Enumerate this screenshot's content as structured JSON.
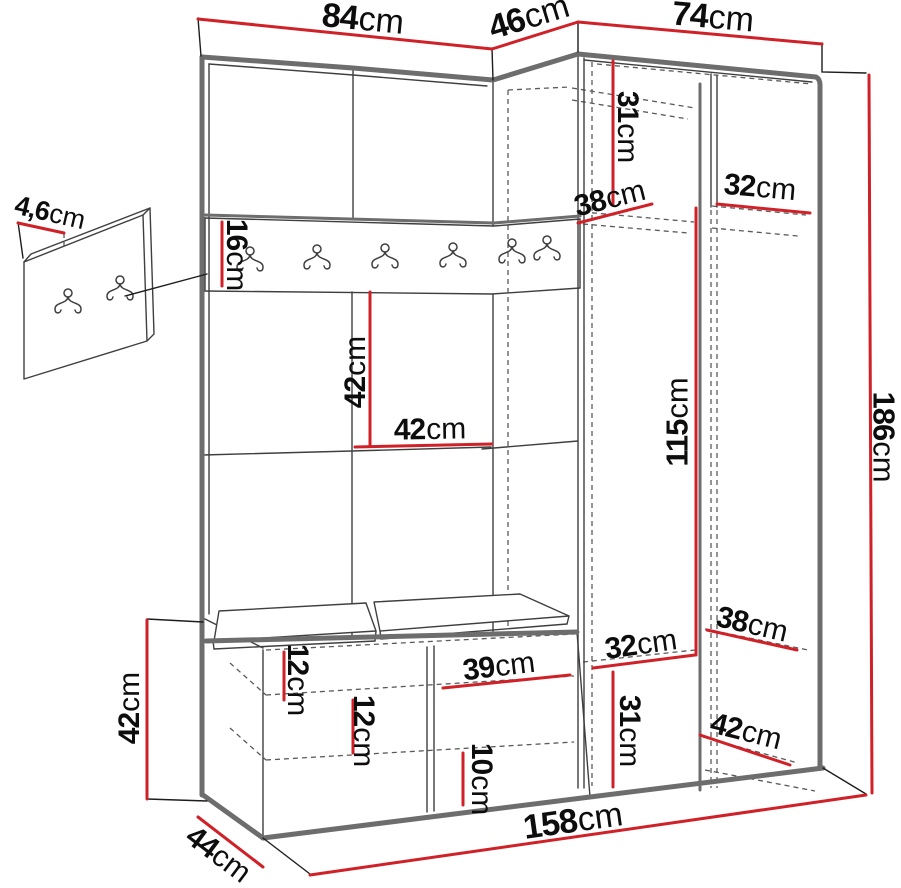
{
  "title": "hallway-wardrobe-dimension-diagram",
  "unit_default": "cm",
  "colors": {
    "dimension_red": "#cf2127",
    "line_dark": "#3f3f3f",
    "edge_gray": "#6d6d6d",
    "background": "#ffffff",
    "text": "#0d0d0d"
  },
  "dims": {
    "top_left_width": {
      "v": "84",
      "u": "cm"
    },
    "corner_depth": {
      "v": "46",
      "u": "cm"
    },
    "top_right_width": {
      "v": "74",
      "u": "cm"
    },
    "wall_panel_thickness": {
      "v": "4,6",
      "u": "cm"
    },
    "hook_rail_height": {
      "v": "16",
      "u": "cm"
    },
    "upper_shelf_drop": {
      "v": "31",
      "u": "cm"
    },
    "upper_shelf_depth_left": {
      "v": "38",
      "u": "cm"
    },
    "upper_shelf_depth_right": {
      "v": "32",
      "u": "cm"
    },
    "hanging_space_height": {
      "v": "115",
      "u": "cm"
    },
    "total_height": {
      "v": "186",
      "u": "cm"
    },
    "middle_gap_height": {
      "v": "42",
      "u": "cm"
    },
    "middle_shelf_width": {
      "v": "42",
      "u": "cm"
    },
    "bench_height": {
      "v": "42",
      "u": "cm"
    },
    "seat_board_gap": {
      "v": "12",
      "u": "cm"
    },
    "bench_shelf_gap": {
      "v": "12",
      "u": "cm"
    },
    "bench_compartment_width": {
      "v": "39",
      "u": "cm"
    },
    "bench_bottom_gap": {
      "v": "10",
      "u": "cm"
    },
    "lower_shelf_width": {
      "v": "32",
      "u": "cm"
    },
    "lower_compartment_height": {
      "v": "31",
      "u": "cm"
    },
    "lower_shelf_depth": {
      "v": "38",
      "u": "cm"
    },
    "bottom_shelf_depth": {
      "v": "42",
      "u": "cm"
    },
    "total_width": {
      "v": "158",
      "u": "cm"
    },
    "bench_depth": {
      "v": "44",
      "u": "cm"
    }
  }
}
